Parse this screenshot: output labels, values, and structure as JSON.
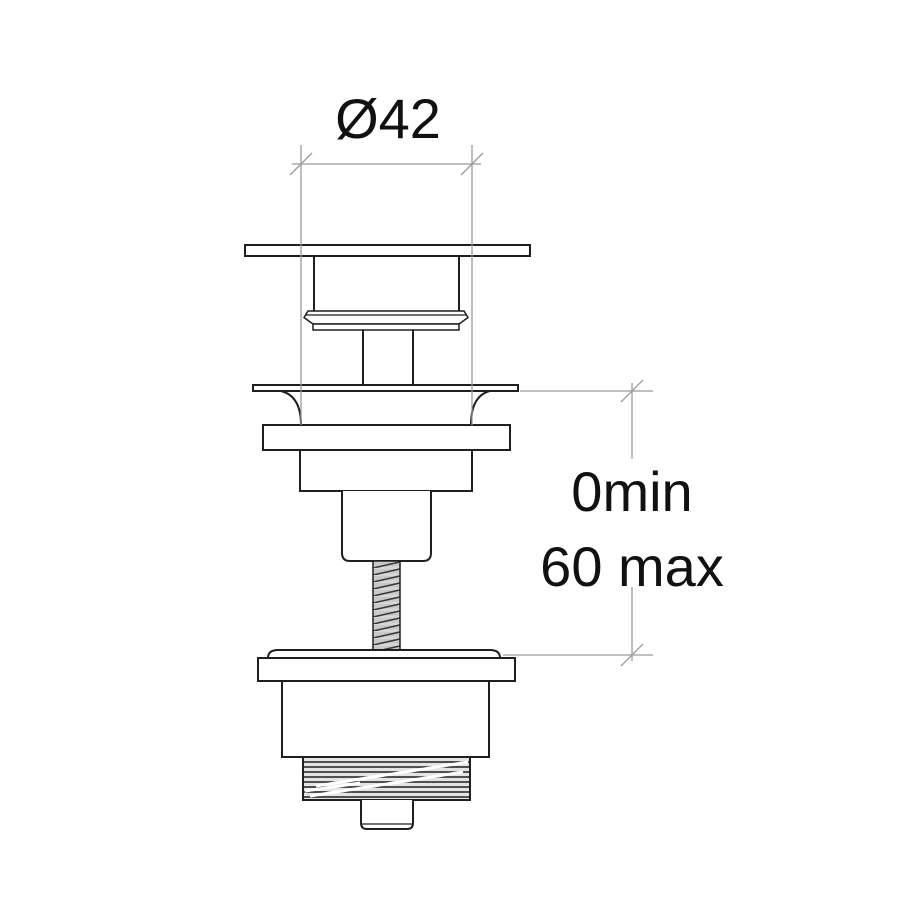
{
  "drawing": {
    "labels": {
      "diameter": "Ø42",
      "depth_min": "0min",
      "depth_max": "60 max"
    },
    "colors": {
      "line": "#1f1f1f",
      "dimension_line": "#9b9b9b",
      "text": "#111111",
      "thread_fill": "#d7d7d7",
      "thread_band": "#c9c9c9",
      "collar_fill": "#e4e4e4",
      "background": "#ffffff"
    }
  }
}
